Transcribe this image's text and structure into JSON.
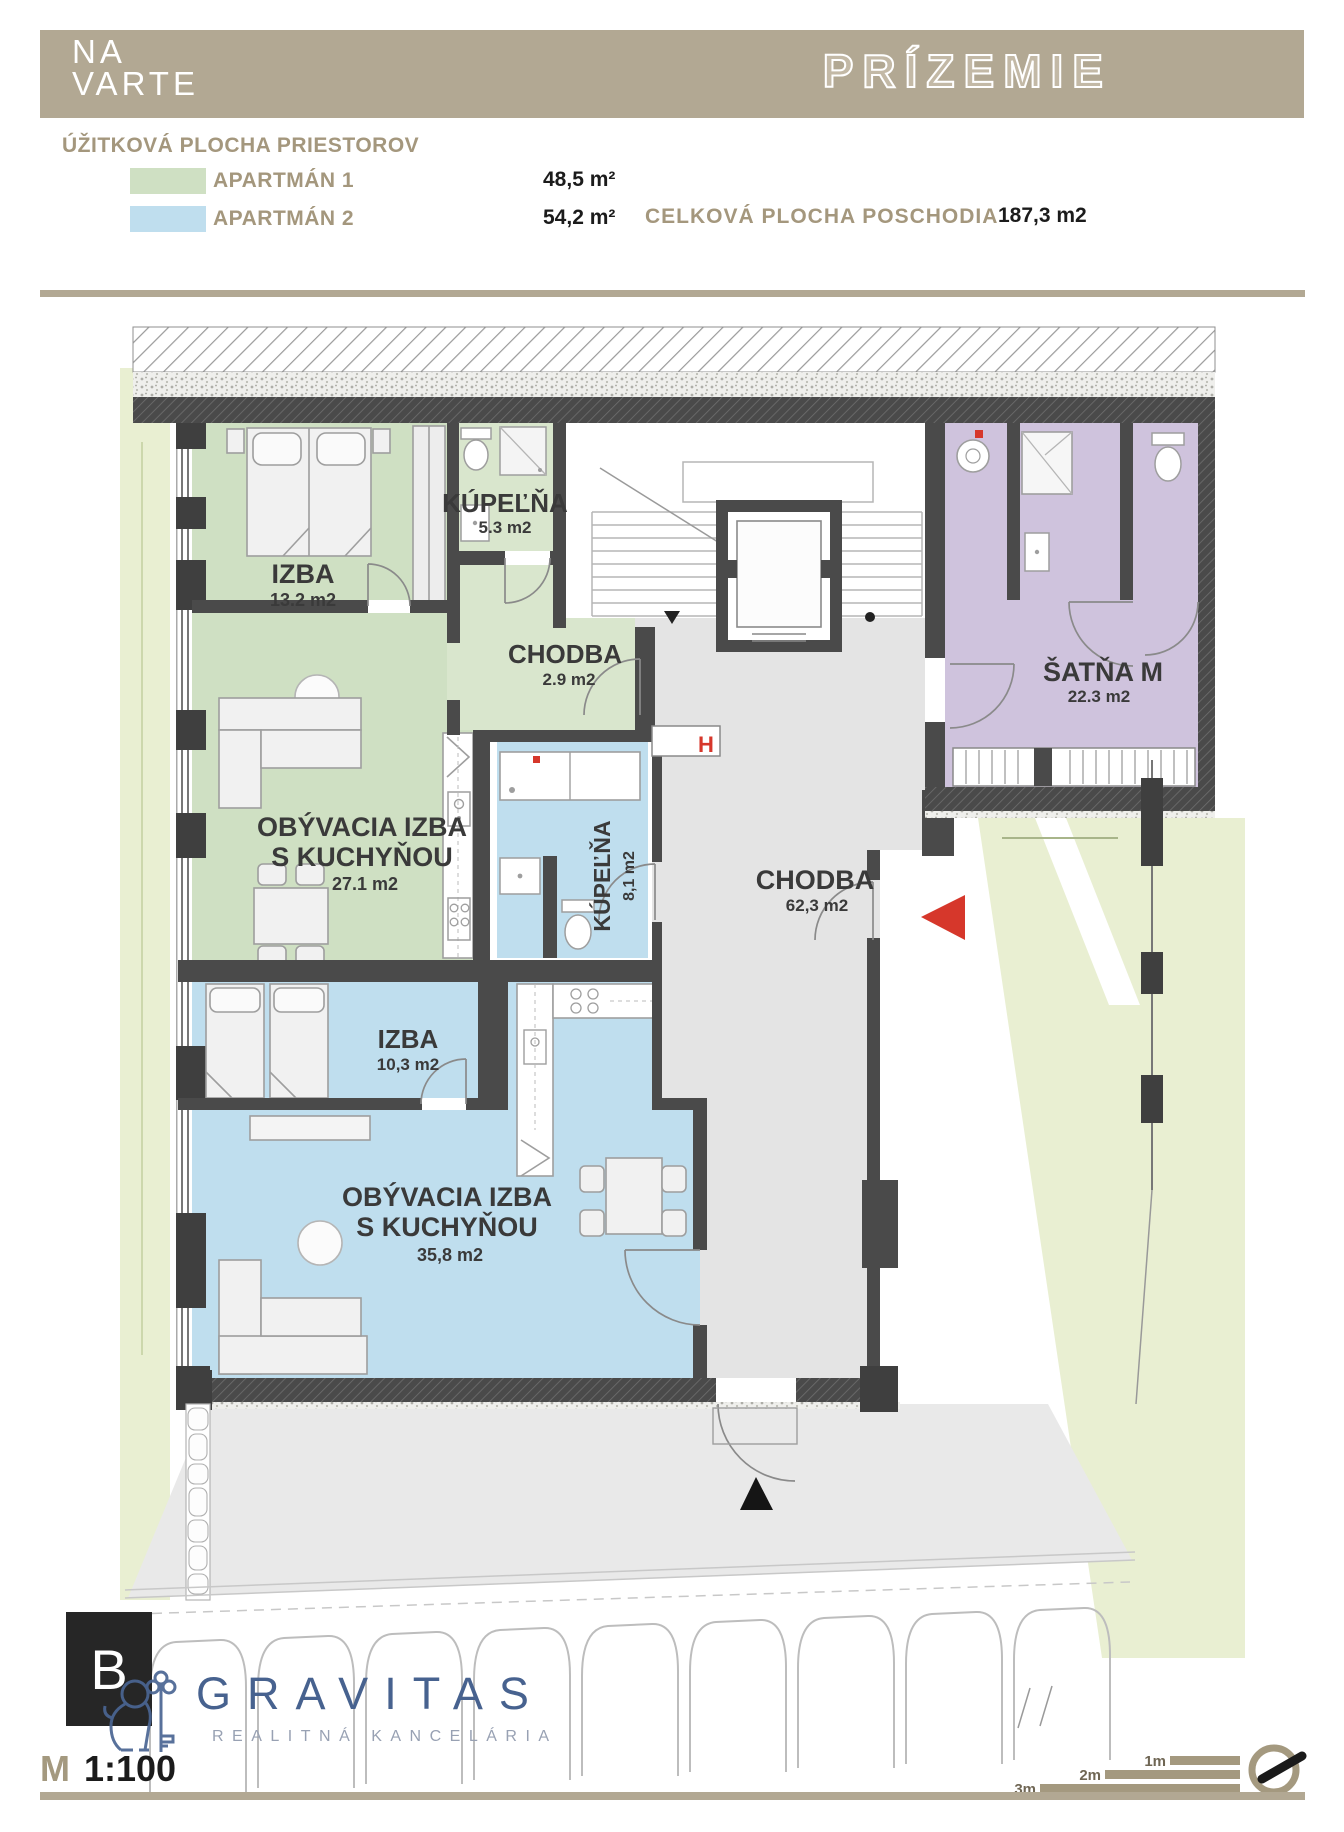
{
  "colors": {
    "header_band": "#b2a893",
    "apartment1_green": "#cfe0c3",
    "apartment2_blue": "#bfdeee",
    "satna_purple": "#cfc3dd",
    "corridor_gray": "#e4e4e4",
    "garden_green": "#e9efd2",
    "wall_dark": "#4a4a4a",
    "accent_red": "#d6372b",
    "brand_blue": "#47628f",
    "taupe": "#a4997f"
  },
  "header": {
    "brand_line1": "NA",
    "brand_line2": "VARTE",
    "floor_title": "PRÍZEMIE"
  },
  "legend": {
    "title": "ÚŽITKOVÁ PLOCHA PRIESTOROV",
    "items": [
      {
        "label": "APARTMÁN 1",
        "area": "48,5 m²"
      },
      {
        "label": "APARTMÁN 2",
        "area": "54,2 m²"
      }
    ],
    "total_label": "CELKOVÁ PLOCHA POSCHODIA",
    "total_value": "187,3 m2"
  },
  "plan": {
    "labels": {
      "izba1": "IZBA",
      "izba1_area": "13.2 m2",
      "kupelna1": "KÚPEĽŇA",
      "kupelna1_area": "5.3 m2",
      "chodba1": "CHODBA",
      "chodba1_area": "2.9 m2",
      "obyv1_l1": "OBÝVACIA IZBA",
      "obyv1_l2": "S KUCHYŇOU",
      "obyv1_area": "27.1 m2",
      "kupelna2": "KÚPEĽŇA",
      "kupelna2_area": "8,1 m2",
      "chodba2": "CHODBA",
      "chodba2_area": "62,3 m2",
      "satna": "ŠATŇA M",
      "satna_area": "22.3 m2",
      "izba2": "IZBA",
      "izba2_area": "10,3 m2",
      "obyv2_l1": "OBÝVACIA IZBA",
      "obyv2_l2": "S KUCHYŇOU",
      "obyv2_area": "35,8 m2",
      "hydrant": "H"
    }
  },
  "footer": {
    "badge": "B",
    "scale_prefix": "M",
    "scale_value": "1:100",
    "brand": "GRAVITAS",
    "brand_subtitle": "REALITNÁ KANCELÁRIA",
    "scale_bars": [
      "3m",
      "2m",
      "1m"
    ]
  }
}
